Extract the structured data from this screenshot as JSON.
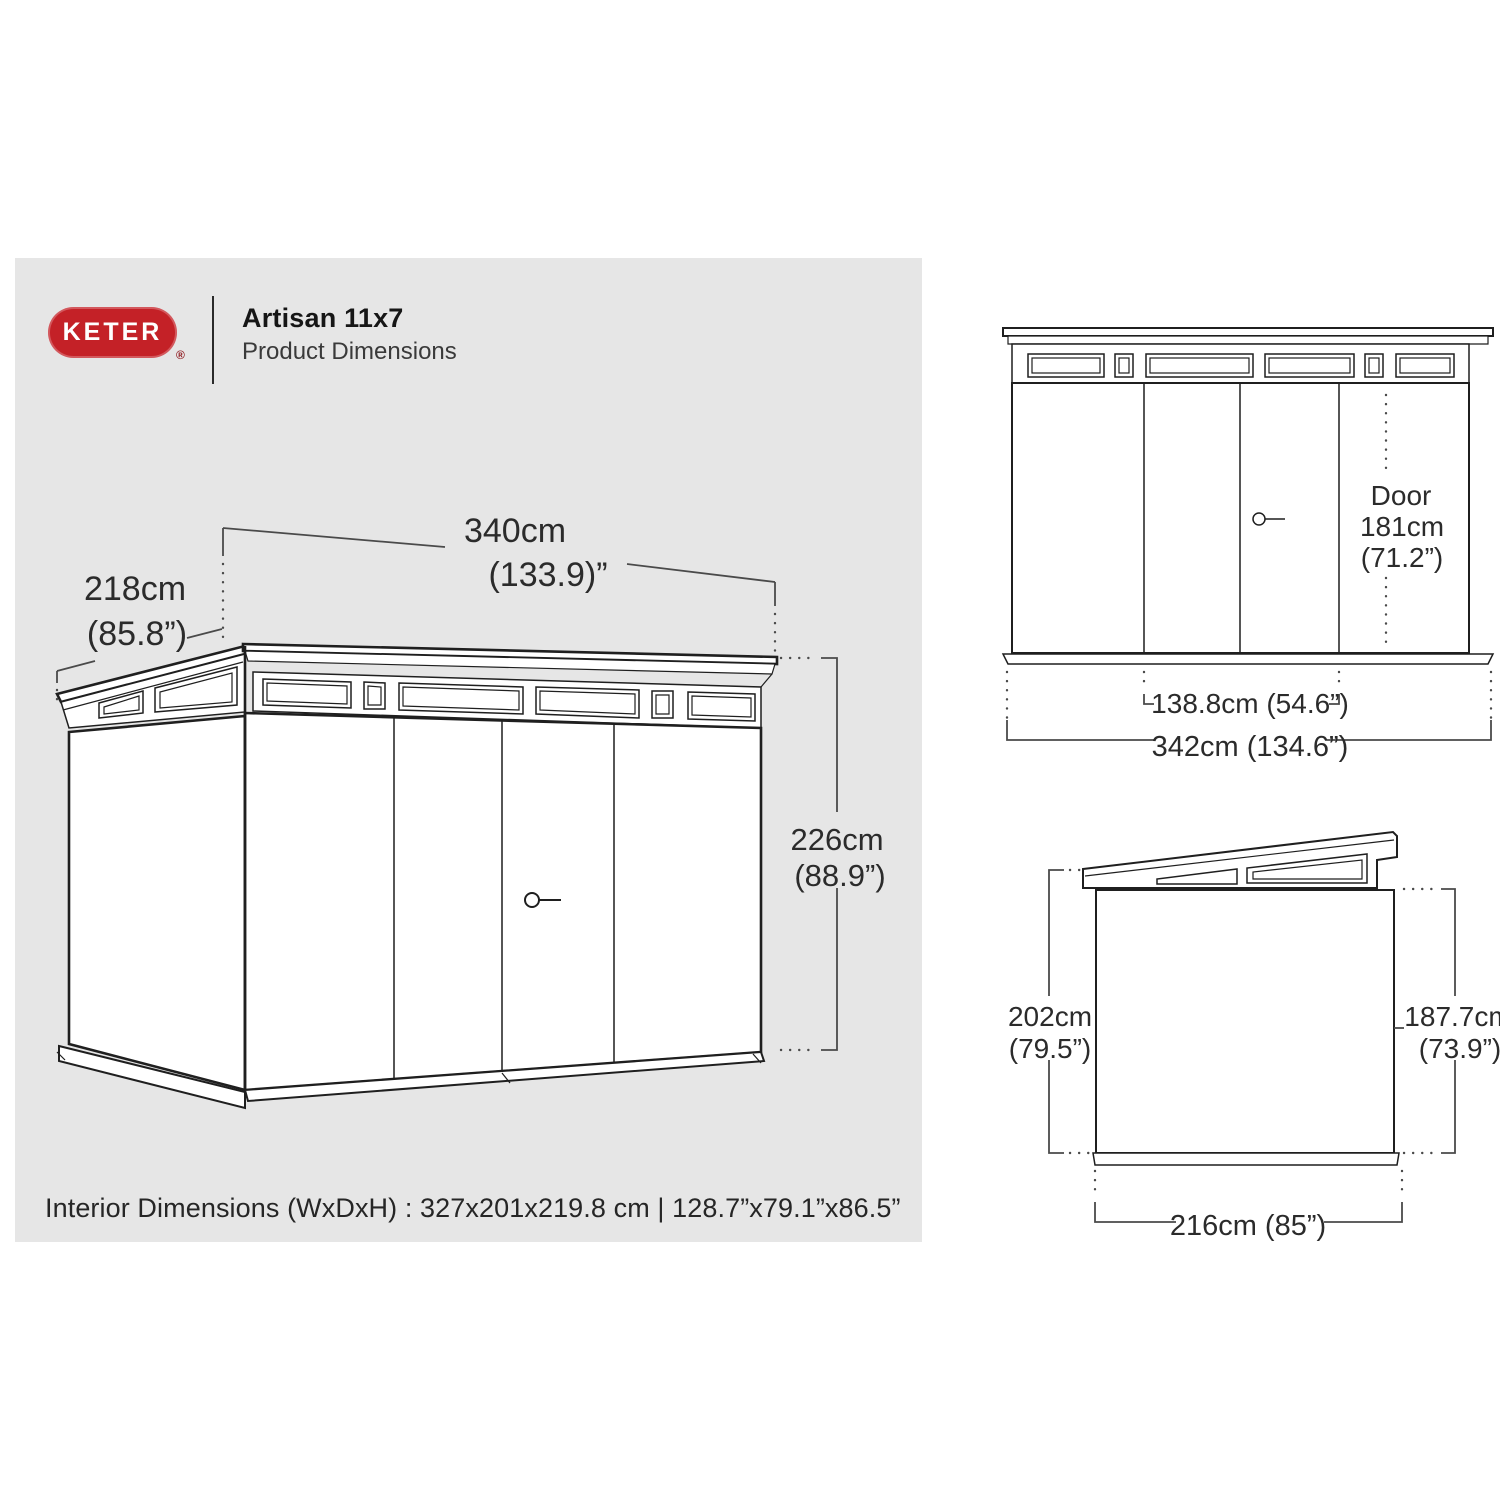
{
  "brand": {
    "logo_text": "KETER",
    "registered_mark": "®"
  },
  "header": {
    "title": "Artisan 11x7",
    "subtitle": "Product Dimensions"
  },
  "main_view": {
    "width_cm": "340cm",
    "width_in": "(133.9)”",
    "depth_cm": "218cm",
    "depth_in": "(85.8”)",
    "height_cm": "226cm",
    "height_in": "(88.9”)"
  },
  "front_view": {
    "door_line1": "Door",
    "door_line2": "181cm",
    "door_line3": "(71.2”)",
    "door_width": "138.8cm (54.6”)",
    "overall_width": "342cm (134.6”)"
  },
  "side_view": {
    "left_height_cm": "202cm",
    "left_height_in": "(79.5”)",
    "right_height_cm": "187.7cm",
    "right_height_in": "(73.9”)",
    "depth": "216cm (85”)"
  },
  "footer": {
    "interior_dimensions": "Interior Dimensions (WxDxH) : 327x201x219.8 cm | 128.7”x79.1”x86.5”"
  },
  "colors": {
    "brand_red": "#c42127",
    "panel_gray": "#e6e6e6",
    "line_dark": "#1f1f1f",
    "dim_gray": "#4a4a4a",
    "text_dark": "#2b2b2b"
  }
}
